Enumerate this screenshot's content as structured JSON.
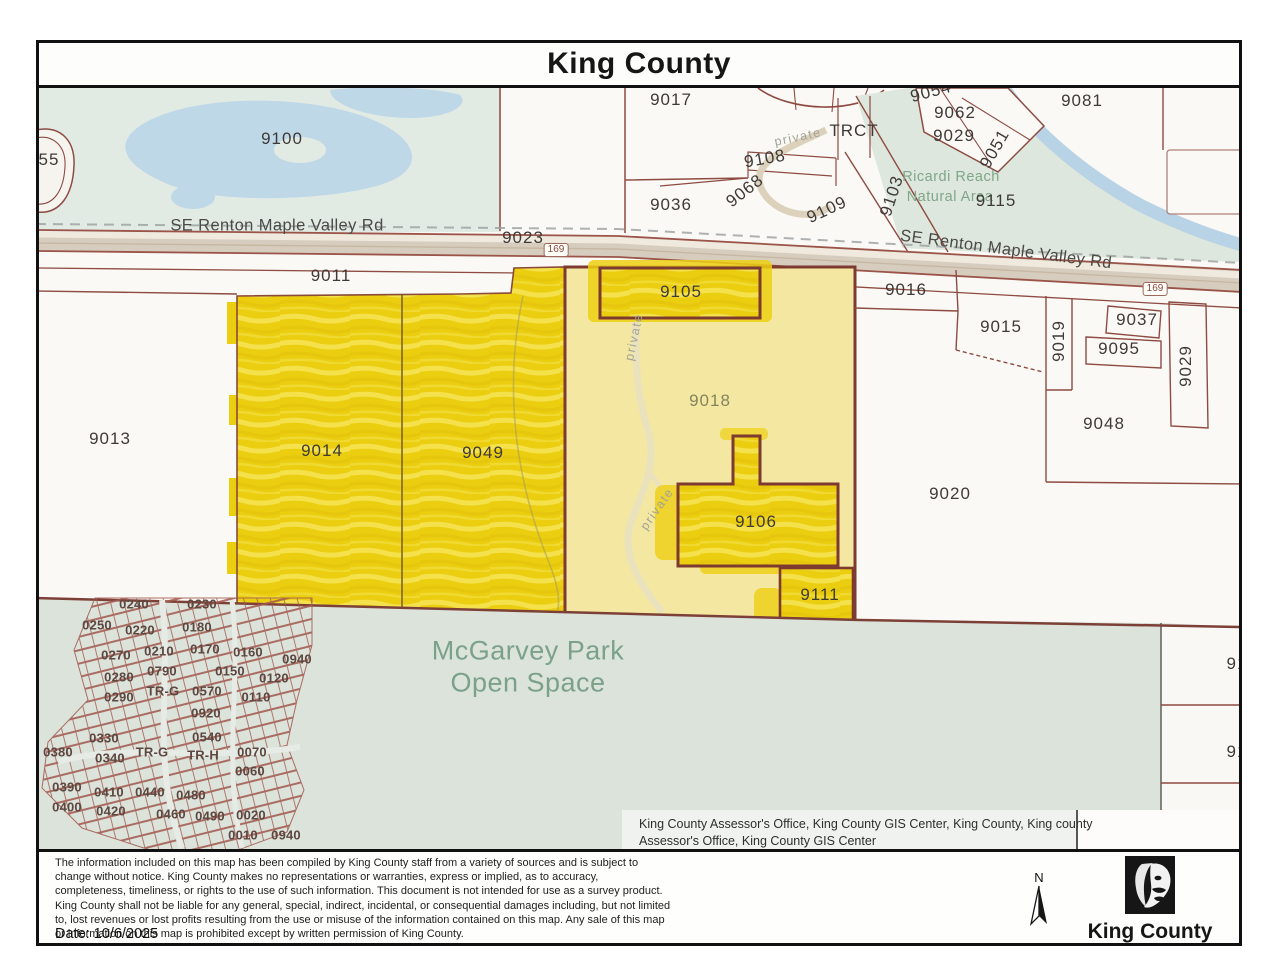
{
  "window": {
    "title": "King County"
  },
  "map": {
    "attribution": "King County Assessor's Office, King County GIS Center, King County, King county Assessor's Office, King County GIS Center",
    "colors": {
      "highlight_yellow": "#ecce10",
      "parcel_pale_yellow": "#f4e7a2",
      "park_green": "#dbe3db",
      "water_blue": "#bfd8e8",
      "boundary_maroon": "#8d4b42"
    },
    "labels": [
      {
        "t": "9100",
        "x": 282,
        "y": 139
      },
      {
        "t": "55",
        "x": 49,
        "y": 160
      },
      {
        "t": "9017",
        "x": 671,
        "y": 100
      },
      {
        "t": "9036",
        "x": 671,
        "y": 205
      },
      {
        "t": "9108",
        "x": 765,
        "y": 159,
        "r": -10
      },
      {
        "t": "9068",
        "x": 745,
        "y": 191,
        "r": -38
      },
      {
        "t": "TRCT",
        "x": 854,
        "y": 131
      },
      {
        "t": "9109",
        "x": 827,
        "y": 210,
        "r": -25
      },
      {
        "t": "private",
        "x": 798,
        "y": 137,
        "r": -12,
        "c": "roadsm"
      },
      {
        "t": "9054",
        "x": 931,
        "y": 92,
        "r": -15
      },
      {
        "t": "9062",
        "x": 955,
        "y": 113
      },
      {
        "t": "9029",
        "x": 954,
        "y": 136
      },
      {
        "t": "9051",
        "x": 995,
        "y": 149,
        "r": -60
      },
      {
        "t": "9103",
        "x": 892,
        "y": 196,
        "r": -72
      },
      {
        "t": "Ricardi Reach",
        "x": 951,
        "y": 177,
        "c": "green"
      },
      {
        "t": "Natural Area",
        "x": 950,
        "y": 197,
        "c": "green"
      },
      {
        "t": "9115",
        "x": 996,
        "y": 201
      },
      {
        "t": "9081",
        "x": 1082,
        "y": 101
      },
      {
        "t": "SE Renton Maple Valley Rd",
        "x": 277,
        "y": 226,
        "c": "road"
      },
      {
        "t": "9023",
        "x": 523,
        "y": 238
      },
      {
        "t": "169",
        "x": 556,
        "y": 250,
        "c": "shield"
      },
      {
        "t": "SE Renton Maple Valley Rd",
        "x": 1006,
        "y": 250,
        "r": 7.5,
        "c": "road"
      },
      {
        "t": "169",
        "x": 1155,
        "y": 289,
        "c": "shield"
      },
      {
        "t": "9011",
        "x": 331,
        "y": 276
      },
      {
        "t": "9013",
        "x": 110,
        "y": 439
      },
      {
        "t": "9014",
        "x": 322,
        "y": 451
      },
      {
        "t": "9049",
        "x": 483,
        "y": 453
      },
      {
        "t": "9105",
        "x": 681,
        "y": 292
      },
      {
        "t": "9018",
        "x": 710,
        "y": 401,
        "c": "olive"
      },
      {
        "t": "private",
        "x": 634,
        "y": 337,
        "r": -78,
        "c": "roadsm"
      },
      {
        "t": "private",
        "x": 657,
        "y": 509,
        "r": -55,
        "c": "roadsm"
      },
      {
        "t": "9106",
        "x": 756,
        "y": 522
      },
      {
        "t": "9111",
        "x": 820,
        "y": 595
      },
      {
        "t": "9016",
        "x": 906,
        "y": 290
      },
      {
        "t": "9015",
        "x": 1001,
        "y": 327
      },
      {
        "t": "9019",
        "x": 1059,
        "y": 341,
        "r": -90
      },
      {
        "t": "9037",
        "x": 1137,
        "y": 320
      },
      {
        "t": "9095",
        "x": 1119,
        "y": 349
      },
      {
        "t": "9029",
        "x": 1186,
        "y": 366,
        "r": -90
      },
      {
        "t": "9048",
        "x": 1104,
        "y": 424
      },
      {
        "t": "9020",
        "x": 950,
        "y": 494
      },
      {
        "t": "McGarvey Park",
        "x": 528,
        "y": 651,
        "c": "park"
      },
      {
        "t": "Open Space",
        "x": 528,
        "y": 683,
        "c": "park"
      },
      {
        "t": "91",
        "x": 1237,
        "y": 664
      },
      {
        "t": "91",
        "x": 1237,
        "y": 752
      },
      {
        "t": "0240",
        "x": 134,
        "y": 604,
        "c": "tiny"
      },
      {
        "t": "0230",
        "x": 202,
        "y": 604,
        "c": "tiny"
      },
      {
        "t": "0250",
        "x": 97,
        "y": 625,
        "c": "tiny"
      },
      {
        "t": "0220",
        "x": 140,
        "y": 630,
        "c": "tiny"
      },
      {
        "t": "0180",
        "x": 197,
        "y": 627,
        "c": "tiny"
      },
      {
        "t": "0270",
        "x": 116,
        "y": 655,
        "c": "tiny"
      },
      {
        "t": "0210",
        "x": 159,
        "y": 651,
        "c": "tiny"
      },
      {
        "t": "0170",
        "x": 205,
        "y": 649,
        "c": "tiny"
      },
      {
        "t": "0160",
        "x": 248,
        "y": 652,
        "c": "tiny"
      },
      {
        "t": "0940",
        "x": 297,
        "y": 659,
        "c": "tiny"
      },
      {
        "t": "0280",
        "x": 119,
        "y": 677,
        "c": "tiny"
      },
      {
        "t": "0790",
        "x": 162,
        "y": 671,
        "c": "tiny"
      },
      {
        "t": "0150",
        "x": 230,
        "y": 671,
        "c": "tiny"
      },
      {
        "t": "0120",
        "x": 274,
        "y": 678,
        "c": "tiny"
      },
      {
        "t": "0290",
        "x": 119,
        "y": 697,
        "c": "tiny"
      },
      {
        "t": "TR-G",
        "x": 163,
        "y": 691,
        "c": "tiny"
      },
      {
        "t": "0570",
        "x": 207,
        "y": 691,
        "c": "tiny"
      },
      {
        "t": "0110",
        "x": 256,
        "y": 697,
        "c": "tiny"
      },
      {
        "t": "0920",
        "x": 206,
        "y": 713,
        "c": "tiny"
      },
      {
        "t": "0330",
        "x": 104,
        "y": 738,
        "c": "tiny"
      },
      {
        "t": "0540",
        "x": 207,
        "y": 737,
        "c": "tiny"
      },
      {
        "t": "0380",
        "x": 58,
        "y": 752,
        "c": "tiny"
      },
      {
        "t": "0340",
        "x": 110,
        "y": 758,
        "c": "tiny"
      },
      {
        "t": "TR-G",
        "x": 152,
        "y": 752,
        "c": "tiny"
      },
      {
        "t": "TR-H",
        "x": 203,
        "y": 755,
        "c": "tiny"
      },
      {
        "t": "0070",
        "x": 252,
        "y": 752,
        "c": "tiny"
      },
      {
        "t": "0060",
        "x": 250,
        "y": 771,
        "c": "tiny"
      },
      {
        "t": "0390",
        "x": 67,
        "y": 787,
        "c": "tiny"
      },
      {
        "t": "0410",
        "x": 109,
        "y": 792,
        "c": "tiny"
      },
      {
        "t": "0440",
        "x": 150,
        "y": 792,
        "c": "tiny"
      },
      {
        "t": "0480",
        "x": 191,
        "y": 795,
        "c": "tiny"
      },
      {
        "t": "0400",
        "x": 67,
        "y": 807,
        "c": "tiny"
      },
      {
        "t": "0420",
        "x": 111,
        "y": 811,
        "c": "tiny"
      },
      {
        "t": "0460",
        "x": 171,
        "y": 814,
        "c": "tiny"
      },
      {
        "t": "0490",
        "x": 210,
        "y": 816,
        "c": "tiny"
      },
      {
        "t": "0020",
        "x": 251,
        "y": 815,
        "c": "tiny"
      },
      {
        "t": "0010",
        "x": 243,
        "y": 835,
        "c": "tiny"
      },
      {
        "t": "0940",
        "x": 286,
        "y": 835,
        "c": "tiny"
      }
    ]
  },
  "footer": {
    "disclaimer": "The information included on this map has been compiled by King County staff from a variety of sources and is subject to change without notice.  King County makes no representations or warranties, express or implied, as to accuracy, completeness, timeliness, or rights to the use of such information. This document is not intended for use as a survey product. King County shall not be liable for any general, special, indirect, incidental, or consequential damages including, but not limited to, lost revenues or lost profits resulting from the use or misuse of the information contained on this map. Any sale of this map or information on this map is prohibited except by written permission of King County.",
    "date": "Date: 10/6/2025",
    "north_label": "N",
    "logo_label": "King County"
  }
}
